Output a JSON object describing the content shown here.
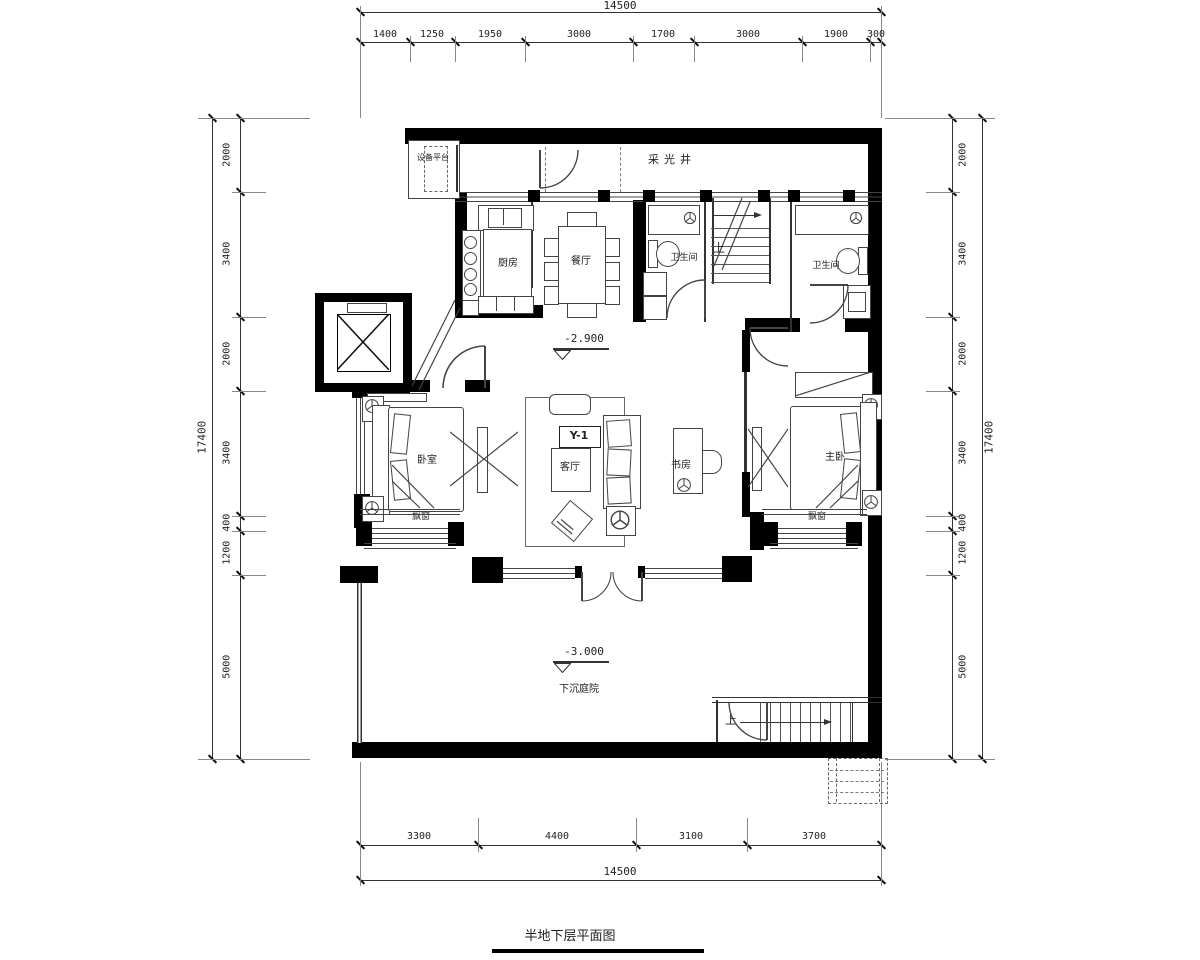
{
  "title": "半地下层平面图",
  "levels": {
    "floor": "-2.900",
    "courtyard": "-3.000"
  },
  "rooms": {
    "equipment_platform": "设备平台",
    "light_well": "采光井",
    "kitchen": "厨房",
    "dining_room": "餐厅",
    "bathroom_1": "卫生间",
    "bathroom_2": "卫生间",
    "bedroom": "卧室",
    "living_room": "客厅",
    "study": "书房",
    "master_bedroom": "主卧",
    "bay_window_left": "飘窗",
    "bay_window_right": "飘窗",
    "sunken_courtyard": "下沉庭院"
  },
  "annotations": {
    "unit_mark": "Y-1",
    "stair_up_top": "上",
    "stair_up_bottom": "上"
  },
  "dimensions": {
    "top": {
      "total": "14500",
      "segments": [
        "1400",
        "1250",
        "1950",
        "3000",
        "1700",
        "3000",
        "1900",
        "300"
      ]
    },
    "bottom": {
      "total": "14500",
      "segments": [
        "3300",
        "4400",
        "3100",
        "3700"
      ]
    },
    "left": {
      "total": "17400",
      "segments": [
        "2000",
        "3400",
        "2000",
        "3400",
        "400",
        "1200",
        "5000"
      ]
    },
    "right": {
      "total": "17400",
      "segments": [
        "2000",
        "3400",
        "2000",
        "3400",
        "400",
        "1200",
        "5000"
      ]
    }
  },
  "colors": {
    "wall": "#000000",
    "line": "#444444",
    "dim_line": "#333333",
    "background": "#ffffff"
  }
}
